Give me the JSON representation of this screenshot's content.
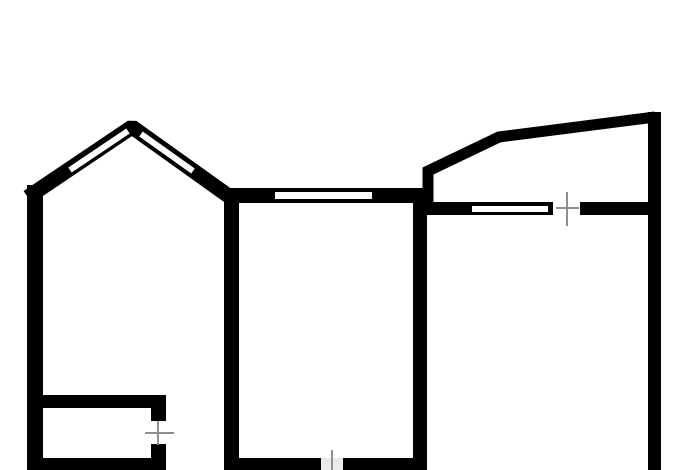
{
  "canvas": {
    "width": 700,
    "height": 470,
    "background": "#ffffff"
  },
  "colors": {
    "wall": "#000000",
    "window": "#ffffff",
    "door_mark": "#8f8f8f",
    "door_gap": "#ececec"
  },
  "floor_plan": {
    "wall_rects": [
      {
        "name": "left-exterior-wall",
        "x": 27,
        "y": 185,
        "w": 16,
        "h": 285
      },
      {
        "name": "partition-wall-left",
        "x": 224,
        "y": 194,
        "w": 15,
        "h": 276
      },
      {
        "name": "partition-wall-right",
        "x": 413,
        "y": 188,
        "w": 14,
        "h": 282
      },
      {
        "name": "right-exterior-wall",
        "x": 648,
        "y": 112,
        "w": 13,
        "h": 358
      },
      {
        "name": "middle-room-top-wall",
        "x": 228,
        "y": 188,
        "w": 199,
        "h": 15
      },
      {
        "name": "right-room-top-wall-left",
        "x": 420,
        "y": 202,
        "w": 133,
        "h": 13
      },
      {
        "name": "right-room-top-wall-right",
        "x": 580,
        "y": 202,
        "w": 68,
        "h": 13
      },
      {
        "name": "small-room-top-wall",
        "x": 40,
        "y": 395,
        "w": 126,
        "h": 13
      },
      {
        "name": "small-room-door-stub-upper",
        "x": 151,
        "y": 395,
        "w": 15,
        "h": 26
      },
      {
        "name": "small-room-door-stub-lower",
        "x": 151,
        "y": 444,
        "w": 15,
        "h": 26
      },
      {
        "name": "small-room-bottom-wall",
        "x": 27,
        "y": 458,
        "w": 139,
        "h": 12
      },
      {
        "name": "bottom-wall-left-of-door",
        "x": 224,
        "y": 458,
        "w": 97,
        "h": 12
      },
      {
        "name": "bottom-wall-right-of-door",
        "x": 343,
        "y": 458,
        "w": 84,
        "h": 12
      }
    ],
    "wall_polylines": [
      {
        "name": "attic-bay-wall",
        "points": "34,193 132,127 230,197",
        "width": 15,
        "cap": "square",
        "join": "bevel"
      },
      {
        "name": "balcony-wall",
        "points": "428,208 428,171 499,137 655,117",
        "width": 11,
        "cap": "butt",
        "join": "miter"
      }
    ],
    "window_rects": [
      {
        "name": "middle-room-window",
        "x": 275,
        "y": 192,
        "w": 97,
        "h": 7
      },
      {
        "name": "right-room-window",
        "x": 472,
        "y": 206,
        "w": 76,
        "h": 6
      }
    ],
    "window_lines": [
      {
        "name": "attic-window-left",
        "x1": 70,
        "y1": 170,
        "x2": 128,
        "y2": 131,
        "width": 6
      },
      {
        "name": "attic-window-right",
        "x1": 141,
        "y1": 134,
        "x2": 193,
        "y2": 171,
        "width": 6
      }
    ],
    "door_gaps": [
      {
        "name": "door-gap-bottom-middle",
        "x": 321,
        "y": 458,
        "w": 22,
        "h": 12
      }
    ],
    "door_marks": [
      {
        "name": "door-mark-right-room-vertical",
        "x1": 567,
        "y1": 192,
        "x2": 567,
        "y2": 226,
        "width": 2
      },
      {
        "name": "door-mark-right-room-horizontal",
        "x1": 556,
        "y1": 208,
        "x2": 579,
        "y2": 208,
        "width": 2
      },
      {
        "name": "door-mark-small-room-horizontal",
        "x1": 145,
        "y1": 433,
        "x2": 174,
        "y2": 433,
        "width": 2
      },
      {
        "name": "door-mark-small-room-vertical",
        "x1": 158,
        "y1": 421,
        "x2": 158,
        "y2": 445,
        "width": 2
      },
      {
        "name": "door-mark-bottom-middle-vertical",
        "x1": 332,
        "y1": 450,
        "x2": 332,
        "y2": 470,
        "width": 2
      }
    ]
  }
}
